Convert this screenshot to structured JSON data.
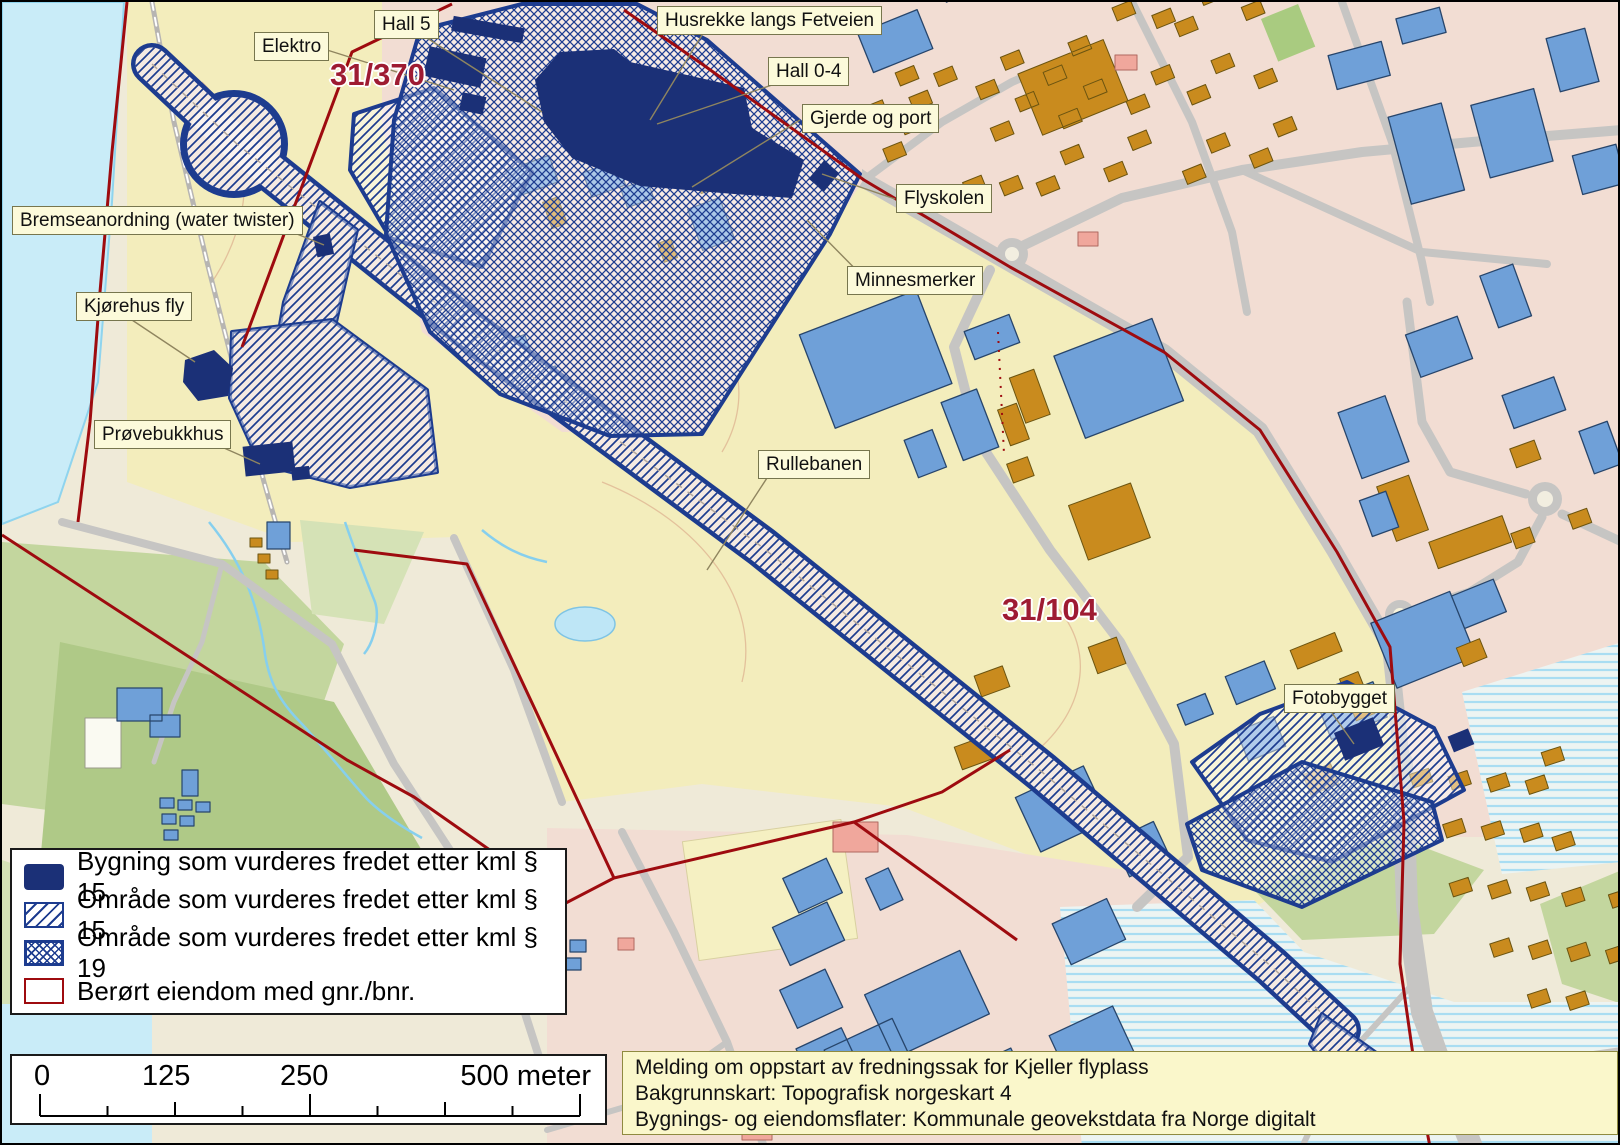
{
  "map_labels": {
    "elektro": "Elektro",
    "hall5": "Hall 5",
    "husrekke": "Husrekke langs Fetveien",
    "hall04": "Hall 0-4",
    "gjerde": "Gjerde og port",
    "flyskolen": "Flyskolen",
    "minnesmerker": "Minnesmerker",
    "bremse": "Bremseanordning (water twister)",
    "kjorehus": "Kjørehus fly",
    "provebukkhus": "Prøvebukkhus",
    "rullebanen": "Rullebanen",
    "fotobygget": "Fotobygget"
  },
  "parcels": {
    "p1": "31/370",
    "p2": "31/104"
  },
  "legend": {
    "item1": "Bygning som vurderes fredet etter kml § 15",
    "item2": "Område som vurderes fredet etter kml § 15",
    "item3": "Område som vurderes fredet etter kml § 19",
    "item4": "Berørt eiendom med gnr./bnr."
  },
  "scalebar": {
    "t0": "0",
    "t125": "125",
    "t250": "250",
    "t500": "500 meter"
  },
  "infobox": {
    "line1": "Melding om oppstart av fredningssak for Kjeller flyplass",
    "line2": "Bakgrunnskart: Topografisk norgeskart 4",
    "line3": "Bygnings- og eiendomsflater: Kommunale geovekstdata fra Norge digitalt"
  },
  "colors": {
    "protected_navy": "#1B3077",
    "area_border": "#1D3C8F",
    "boundary_red": "#9E0B0F",
    "parcel_text": "#9E1B32",
    "label_bg": "#FCFADA",
    "building_orange": "#C98B1E",
    "building_blue": "#6FA0D8",
    "water": "#C9ECF8",
    "field": "#F3EDBC",
    "urban": "#F2DDD3",
    "road": "#C6C5C3",
    "green": "#C3D69E",
    "info_bg": "#FAF7CB"
  }
}
